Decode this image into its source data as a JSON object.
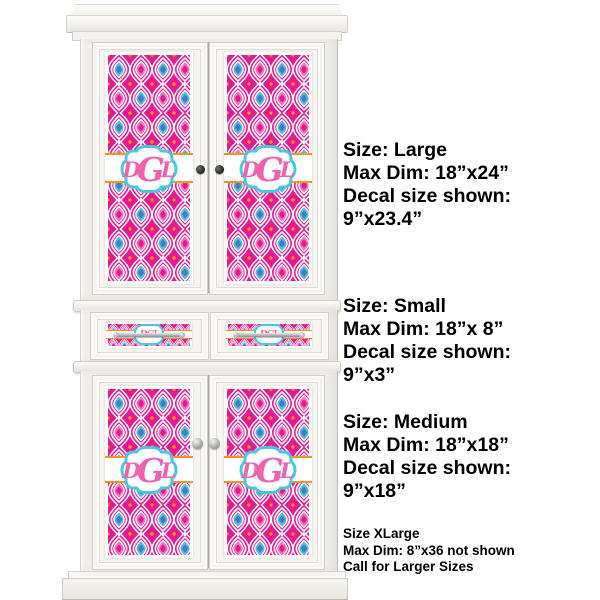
{
  "product_preview": {
    "item": "armoire-with-pattern-decals",
    "pattern_name": "pink-ikat-trellis",
    "monogram": {
      "first": "D",
      "middle": "G",
      "last": "L",
      "letters": "DGL"
    },
    "colors": {
      "magenta": "#e8188f",
      "pink_inner": "#f373bb",
      "teal": "#41c3da",
      "blue": "#4a77c9",
      "orange": "#f7941d",
      "frame_turquoise": "#48c8de",
      "monogram_pink": "#ef63ad",
      "cabinet_white": "#f4f3ee",
      "text_black": "#000000"
    }
  },
  "size_info": {
    "blocks": [
      {
        "title": "Size: Large",
        "max_dim": "Max Dim: 18”x24”",
        "decal_line": "Decal size shown:",
        "decal_size": "9”x23.4”"
      },
      {
        "title": "Size: Small",
        "max_dim": "Max Dim: 18”x 8”",
        "decal_line": "Decal size shown:",
        "decal_size": "9”x3”"
      },
      {
        "title": "Size: Medium",
        "max_dim": "Max Dim: 18”x18”",
        "decal_line": "Decal size shown:",
        "decal_size": "9”x18”"
      }
    ],
    "xlarge": {
      "title": "Size XLarge",
      "max_dim": "Max Dim: 8”x36 not shown",
      "note": "Call for Larger Sizes"
    }
  }
}
